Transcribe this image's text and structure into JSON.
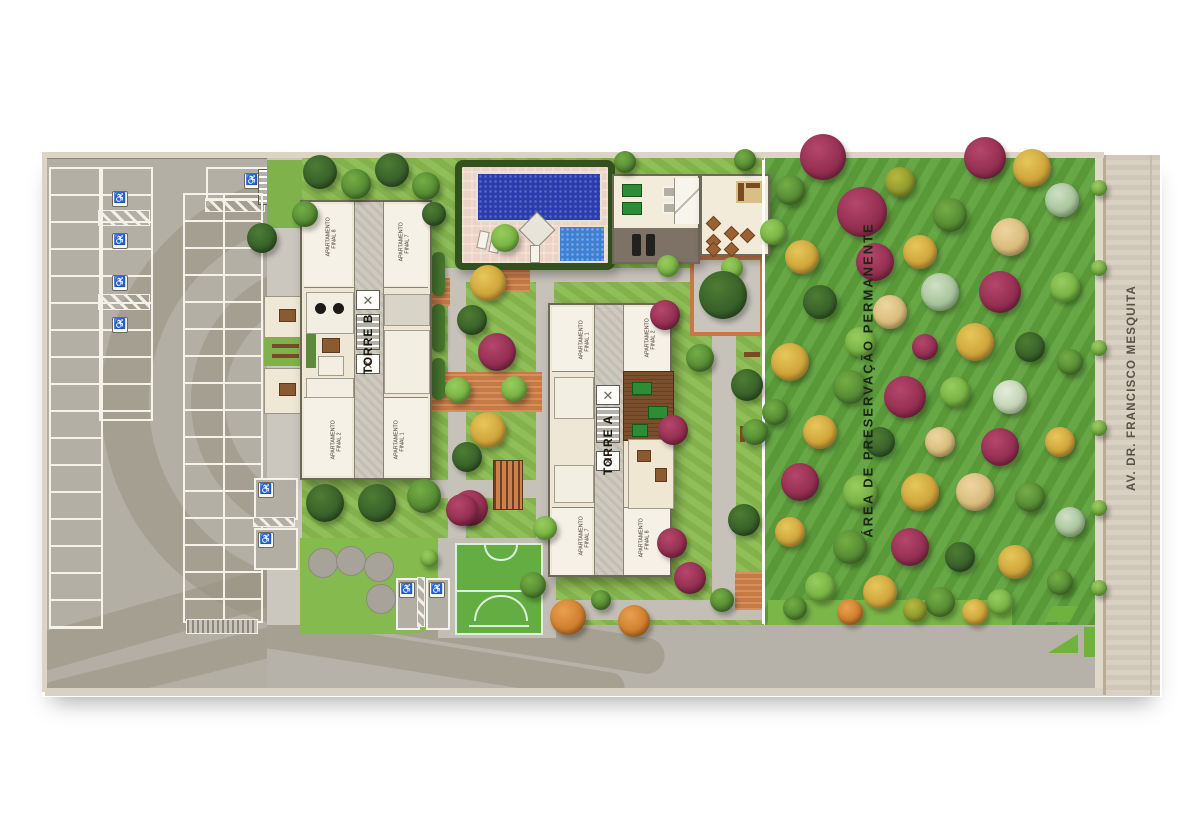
{
  "labels": {
    "tower_b": "TORRE B",
    "tower_a": "TORRE A",
    "preservation_area": "ÁREA DE PRESERVAÇÃO PERMANENTE",
    "street": "AV. DR. FRANCISCO MESQUITA"
  },
  "tower_b_units": [
    "APARTAMENTO FINAL 8",
    "APARTAMENTO FINAL 7",
    "APARTAMENTO FINAL 2",
    "APARTAMENTO FINAL 1"
  ],
  "tower_a_units": [
    "APARTAMENTO FINAL 1",
    "APARTAMENTO FINAL 2",
    "APARTAMENTO FINAL 7",
    "APARTAMENTO FINAL 8"
  ],
  "icons": {
    "accessible_parking": "♿",
    "elevator": "✕"
  },
  "colors": {
    "site_lawn": "#8abc50",
    "preserve_lawn": "#5fa23c",
    "parking_asphalt": "#b4afa5",
    "parking_arc": "#98927f",
    "road": "#b7b2a9",
    "street": "#d7cfc0",
    "pool_dark": "#2b3cae",
    "pool_light": "#3f7fd4",
    "pool_deck": "#ecd3c6",
    "hedge": "#33511f",
    "building": "#eee7d6",
    "terracotta": "#d08048",
    "court_green": "#63ad42",
    "tree_palette": {
      "dg": [
        "#4e7c33",
        "#39612a",
        "#24431c"
      ],
      "mg": [
        "#74ad46",
        "#568b33",
        "#3a6424"
      ],
      "lg": [
        "#98cc5e",
        "#78b344",
        "#568b2e"
      ],
      "ol": [
        "#b7b93e",
        "#8f9a2c",
        "#6b7a20"
      ],
      "yl": [
        "#e7c75a",
        "#cfa53b",
        "#a37c28"
      ],
      "or": [
        "#e8a04e",
        "#d07f2e",
        "#9c5c1e"
      ],
      "mag": [
        "#b5476b",
        "#942f52",
        "#6b1f3a"
      ],
      "sage": [
        "#cfe0c4",
        "#a8c49a",
        "#7fa075"
      ],
      "tan": [
        "#ecd6a0",
        "#d9bc7c",
        "#b09154"
      ],
      "wh": [
        "#e4ecda",
        "#c3d4b4",
        "#9ab58d"
      ]
    }
  },
  "trees": [
    [
      320,
      172,
      17,
      "dg"
    ],
    [
      356,
      184,
      15,
      "mg"
    ],
    [
      392,
      170,
      17,
      "dg"
    ],
    [
      426,
      186,
      14,
      "mg"
    ],
    [
      305,
      214,
      13,
      "mg"
    ],
    [
      434,
      214,
      12,
      "dg"
    ],
    [
      262,
      238,
      15,
      "dg"
    ],
    [
      488,
      283,
      18,
      "yl"
    ],
    [
      472,
      320,
      15,
      "dg"
    ],
    [
      497,
      352,
      19,
      "mag"
    ],
    [
      458,
      390,
      13,
      "lg"
    ],
    [
      514,
      389,
      13,
      "lg"
    ],
    [
      488,
      430,
      18,
      "yl"
    ],
    [
      467,
      457,
      15,
      "dg"
    ],
    [
      470,
      508,
      18,
      "mag"
    ],
    [
      505,
      238,
      14,
      "lg"
    ],
    [
      625,
      162,
      11,
      "mg"
    ],
    [
      745,
      160,
      11,
      "mg"
    ],
    [
      668,
      266,
      11,
      "lg"
    ],
    [
      732,
      268,
      11,
      "lg"
    ],
    [
      665,
      315,
      15,
      "mag"
    ],
    [
      673,
      430,
      15,
      "mag"
    ],
    [
      672,
      543,
      15,
      "mag"
    ],
    [
      723,
      295,
      24,
      "dg"
    ],
    [
      700,
      358,
      14,
      "mg"
    ],
    [
      747,
      385,
      16,
      "dg"
    ],
    [
      755,
      432,
      13,
      "mg"
    ],
    [
      744,
      520,
      16,
      "dg"
    ],
    [
      325,
      503,
      19,
      "dg"
    ],
    [
      377,
      503,
      19,
      "dg"
    ],
    [
      424,
      496,
      17,
      "mg"
    ],
    [
      462,
      510,
      16,
      "mag"
    ],
    [
      429,
      558,
      9,
      "lg"
    ],
    [
      545,
      528,
      12,
      "lg"
    ],
    [
      533,
      585,
      13,
      "mg"
    ],
    [
      568,
      617,
      18,
      "or"
    ],
    [
      634,
      621,
      16,
      "or"
    ],
    [
      601,
      600,
      10,
      "mg"
    ],
    [
      690,
      578,
      16,
      "mag"
    ],
    [
      722,
      600,
      12,
      "mg"
    ],
    [
      1099,
      188,
      8,
      "lg"
    ],
    [
      1099,
      268,
      8,
      "lg"
    ],
    [
      1099,
      348,
      8,
      "lg"
    ],
    [
      1099,
      428,
      8,
      "lg"
    ],
    [
      1099,
      508,
      8,
      "lg"
    ],
    [
      1099,
      588,
      8,
      "lg"
    ],
    [
      823,
      157,
      23,
      "mag"
    ],
    [
      790,
      190,
      15,
      "mg"
    ],
    [
      862,
      212,
      25,
      "mag"
    ],
    [
      900,
      182,
      15,
      "ol"
    ],
    [
      985,
      158,
      21,
      "mag"
    ],
    [
      1032,
      168,
      19,
      "yl"
    ],
    [
      1062,
      200,
      17,
      "sage"
    ],
    [
      950,
      215,
      17,
      "mg"
    ],
    [
      1010,
      237,
      19,
      "tan"
    ],
    [
      920,
      252,
      17,
      "yl"
    ],
    [
      875,
      262,
      19,
      "mag"
    ],
    [
      802,
      257,
      17,
      "yl"
    ],
    [
      773,
      232,
      13,
      "lg"
    ],
    [
      940,
      292,
      19,
      "sage"
    ],
    [
      1000,
      292,
      21,
      "mag"
    ],
    [
      1065,
      287,
      15,
      "lg"
    ],
    [
      820,
      302,
      17,
      "dg"
    ],
    [
      890,
      312,
      17,
      "tan"
    ],
    [
      860,
      342,
      15,
      "lg"
    ],
    [
      925,
      347,
      13,
      "mag"
    ],
    [
      975,
      342,
      19,
      "yl"
    ],
    [
      1030,
      347,
      15,
      "dg"
    ],
    [
      790,
      362,
      19,
      "yl"
    ],
    [
      1070,
      362,
      13,
      "mg"
    ],
    [
      850,
      387,
      17,
      "mg"
    ],
    [
      905,
      397,
      21,
      "mag"
    ],
    [
      955,
      392,
      15,
      "lg"
    ],
    [
      1010,
      397,
      17,
      "wh"
    ],
    [
      775,
      412,
      13,
      "mg"
    ],
    [
      820,
      432,
      17,
      "yl"
    ],
    [
      880,
      442,
      15,
      "dg"
    ],
    [
      940,
      442,
      15,
      "tan"
    ],
    [
      1000,
      447,
      19,
      "mag"
    ],
    [
      1060,
      442,
      15,
      "yl"
    ],
    [
      800,
      482,
      19,
      "mag"
    ],
    [
      860,
      492,
      17,
      "lg"
    ],
    [
      920,
      492,
      19,
      "yl"
    ],
    [
      975,
      492,
      19,
      "tan"
    ],
    [
      1030,
      497,
      15,
      "mg"
    ],
    [
      1070,
      522,
      15,
      "sage"
    ],
    [
      790,
      532,
      15,
      "yl"
    ],
    [
      850,
      547,
      17,
      "mg"
    ],
    [
      910,
      547,
      19,
      "mag"
    ],
    [
      960,
      557,
      15,
      "dg"
    ],
    [
      1015,
      562,
      17,
      "yl"
    ],
    [
      1060,
      582,
      13,
      "mg"
    ],
    [
      820,
      587,
      15,
      "lg"
    ],
    [
      880,
      592,
      17,
      "yl"
    ],
    [
      940,
      602,
      15,
      "mg"
    ],
    [
      1000,
      602,
      13,
      "lg"
    ],
    [
      795,
      608,
      12,
      "mg"
    ],
    [
      850,
      612,
      13,
      "or"
    ],
    [
      915,
      610,
      12,
      "ol"
    ],
    [
      975,
      612,
      13,
      "yl"
    ]
  ]
}
